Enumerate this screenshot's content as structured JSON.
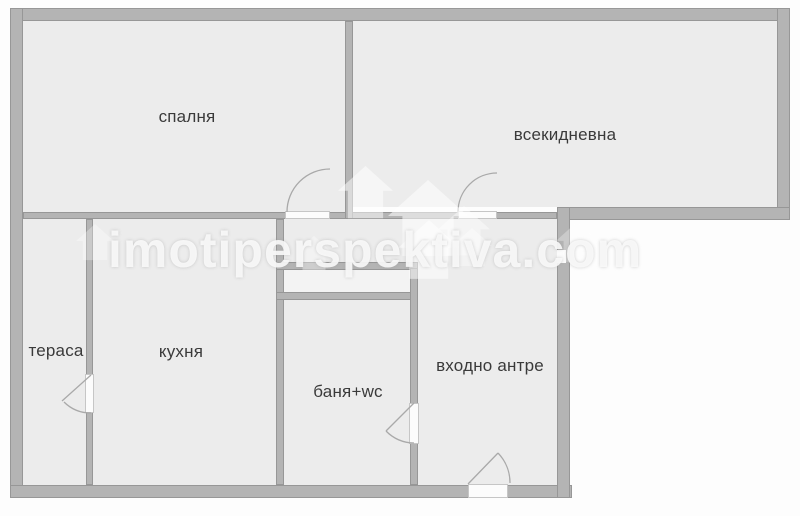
{
  "floorplan": {
    "title": "apartment-floor-plan",
    "watermark": "imotiperspektiva.com",
    "rooms": [
      {
        "id": "bedroom",
        "label": "спалня"
      },
      {
        "id": "living-room",
        "label": "всекидневна"
      },
      {
        "id": "terrace",
        "label": "тераса"
      },
      {
        "id": "kitchen",
        "label": "кухня"
      },
      {
        "id": "bathroom",
        "label": "баня+wc"
      },
      {
        "id": "entrance-hall",
        "label": "входно антре"
      }
    ],
    "doors": [
      "bedroom-door",
      "living-room-door",
      "terrace-door",
      "bathroom-door",
      "entrance-door"
    ],
    "colors": {
      "wall": "#b4b4b4",
      "wall_edge": "#979797",
      "room_fill": "#ececec",
      "background": "#ffffff",
      "label_text": "#3a3a3a",
      "watermark_text": "#fafafa"
    }
  }
}
